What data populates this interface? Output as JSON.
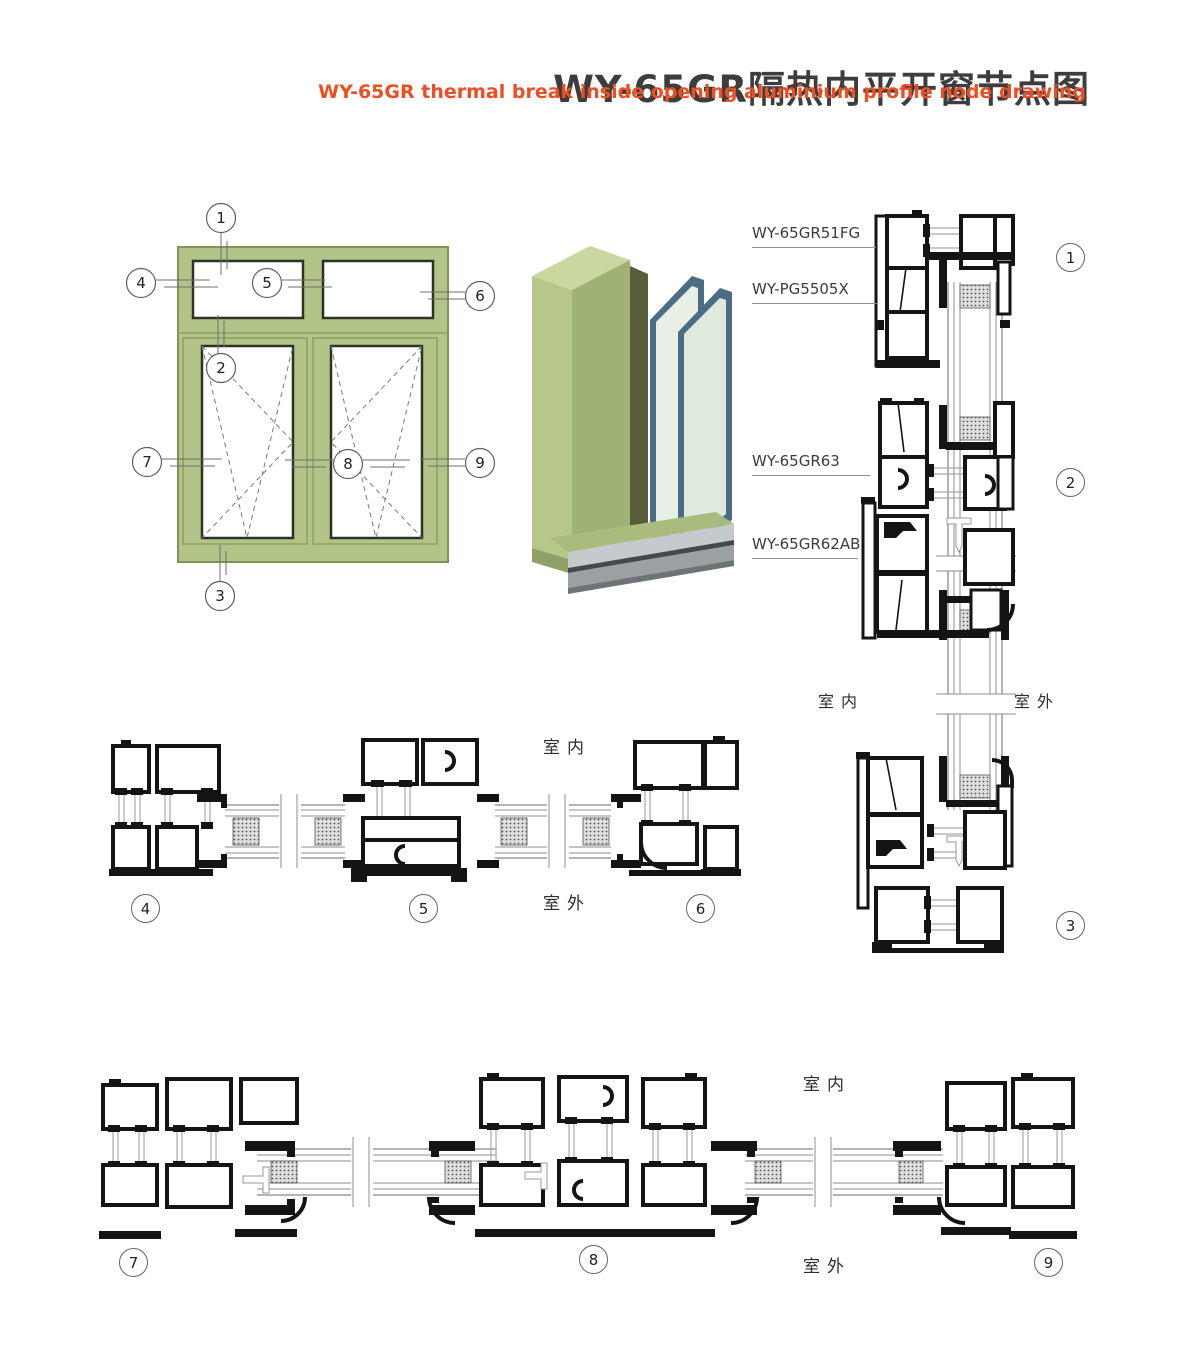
{
  "header": {
    "title": "WY-65GR隔热内平开窗节点图",
    "subtitle": "WY-65GR thermal break inside opening aluminium profile node drawing"
  },
  "legend": {
    "indoor": "室内",
    "outdoor": "室外"
  },
  "profile_labels": {
    "head_frame": "WY-65GR51FG",
    "glazing_bead": "WY-PG5505X",
    "transom_sash": "WY-65GR63",
    "casement_sash": "WY-65GR62AB"
  },
  "callouts": {
    "c1": "1",
    "c2": "2",
    "c3": "3",
    "c4": "4",
    "c5": "5",
    "c6": "6",
    "c7": "7",
    "c8": "8",
    "c9": "9"
  },
  "colors": {
    "accent_orange": "#ee4e22",
    "title_gray": "#3d3d3d",
    "frame_green": "#b2c487",
    "frame_green_dark": "#7f9356",
    "glass_edge_blue": "#4c6c86",
    "drawing_black": "#141414"
  }
}
